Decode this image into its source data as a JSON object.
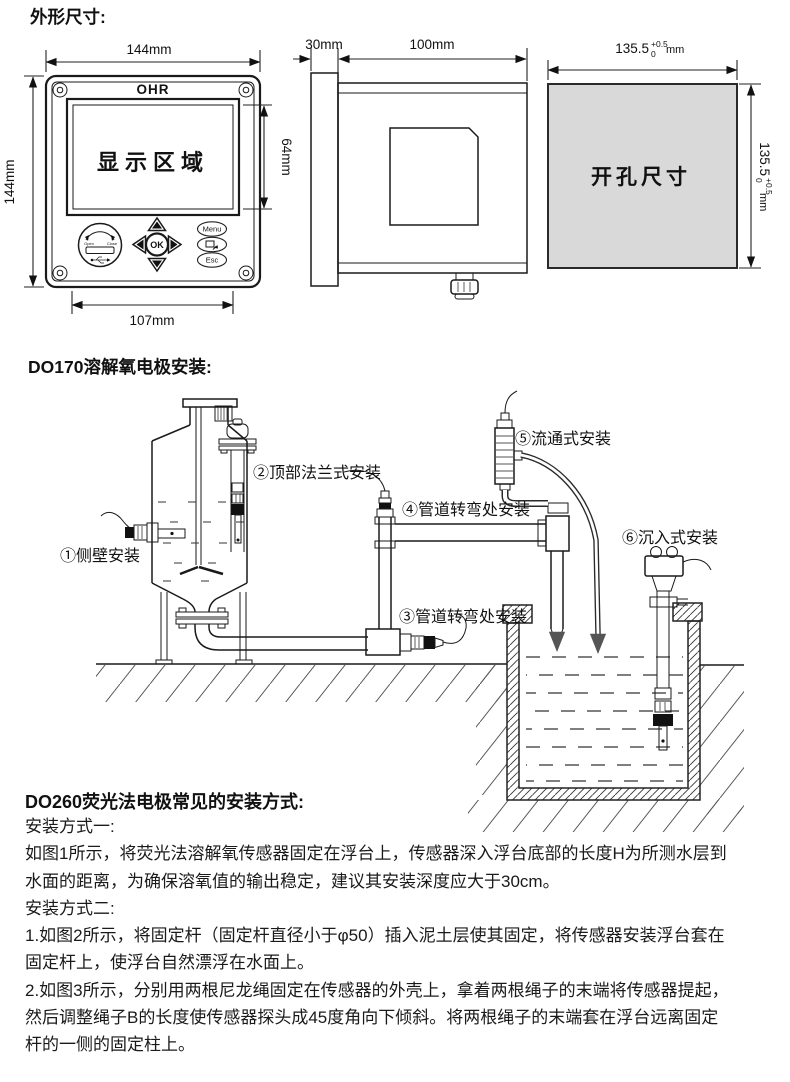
{
  "headings": {
    "outline": "外形尺寸:",
    "do170": "DO170溶解氧电极安装:",
    "do260": "DO260荧光法电极常见的安装方式:"
  },
  "front_panel": {
    "brand": "OHR",
    "display_area": "显示区域",
    "dim_width": "144mm",
    "dim_height": "144mm",
    "dim_display": "64mm",
    "dim_bottom": "107mm",
    "btn_menu": "Menu",
    "btn_ok": "OK",
    "btn_esc": "Esc",
    "usb_open": "Open",
    "usb_close": "Close"
  },
  "side_view": {
    "dim_bezel": "30mm",
    "dim_depth": "100mm"
  },
  "cutout": {
    "label": "开孔尺寸",
    "dim_base": "135.5",
    "tol_plus": "+0.5",
    "tol_minus": "0",
    "unit": "mm",
    "fill": "#d9d9d9"
  },
  "do170_labels": [
    {
      "text": "①侧壁安装"
    },
    {
      "text": "②顶部法兰式安装"
    },
    {
      "text": "③管道转弯处安装"
    },
    {
      "text": "④管道转弯处安装"
    },
    {
      "text": "⑤流通式安装"
    },
    {
      "text": "⑥沉入式安装"
    }
  ],
  "do260_lines": [
    "安装方式一:",
    "如图1所示，将荧光法溶解氧传感器固定在浮台上，传感器深入浮台底部的长度H为所测水层到",
    "水面的距离，为确保溶氧值的输出稳定，建议其安装深度应大于30cm。",
    "安装方式二:",
    "1.如图2所示，将固定杆（固定杆直径小于φ50）插入泥土层使其固定，将传感器安装浮台套在",
    "固定杆上，使浮台自然漂浮在水面上。",
    "2.如图3所示，分别用两根尼龙绳固定在传感器的外壳上，拿着两根绳子的末端将传感器提起，",
    "然后调整绳子B的长度使传感器探头成45度角向下倾斜。将两根绳子的末端套在浮台远离固定",
    "杆的一侧的固定柱上。"
  ]
}
